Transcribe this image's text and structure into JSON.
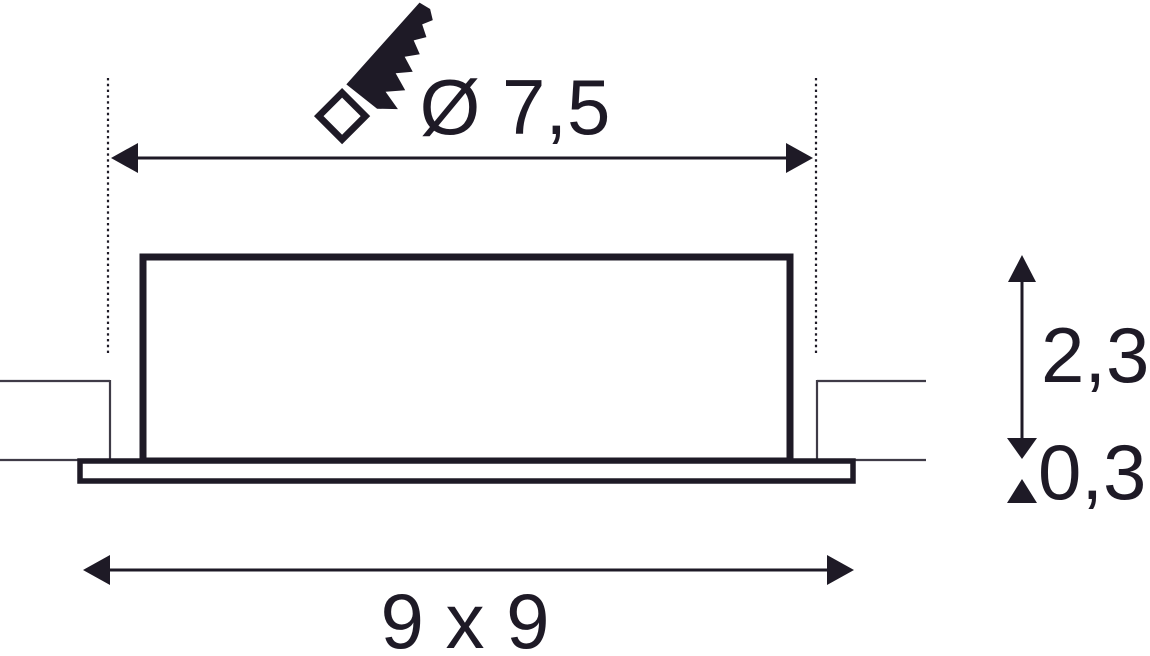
{
  "colors": {
    "ink": "#1e1a26",
    "thin": "#3f3b47",
    "bg": "#ffffff"
  },
  "icons": {
    "saw": "saw-icon"
  },
  "dimensions": {
    "cutout_diameter": {
      "label": "Ø 7,5"
    },
    "housing_height": {
      "label": "2,3"
    },
    "flange_thickness": {
      "label": "0,3"
    },
    "outer_size": {
      "label": "9 x 9"
    }
  }
}
